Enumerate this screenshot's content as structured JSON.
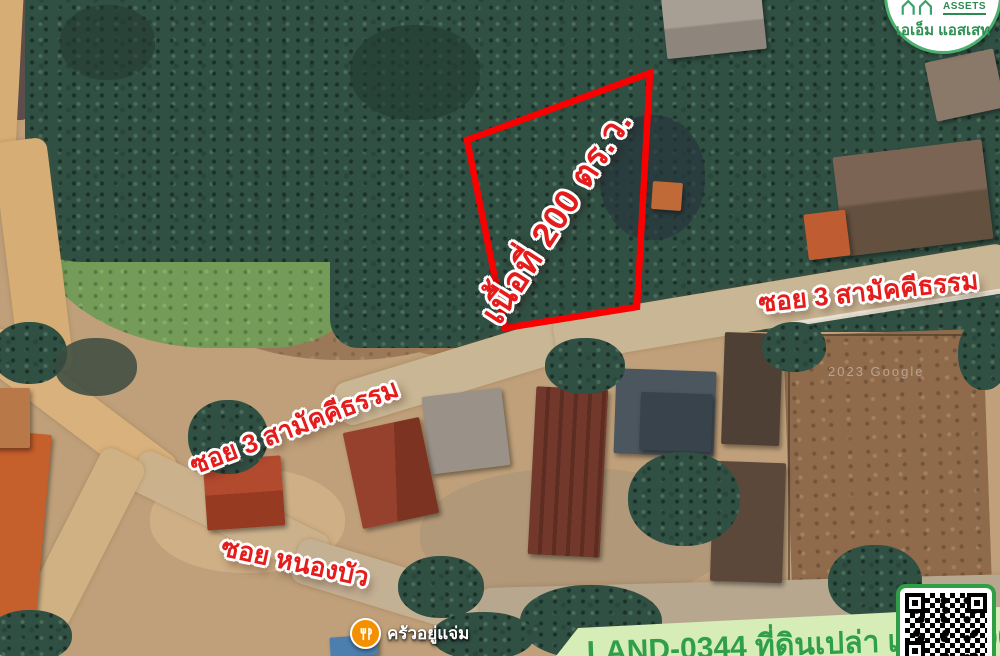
{
  "map": {
    "watermark": "2023 Google",
    "plot_area_label": "เนื้อที่ 200 ตร.ว.",
    "street_labels": {
      "soi3_right": "ซอย 3 สามัคคีธรรม",
      "soi3_left": "ซอย 3 สามัคคีธรรม",
      "soi_nongbua": "ซอย หนองบัว"
    },
    "poi_restaurant": "ครัวอยู่แจ่ม"
  },
  "logo": {
    "brand_en": "ASSETS",
    "brand_th": "เอเอ็ม แอสเสท"
  },
  "footer_banner": {
    "listing_text": "LAND-0344 ที่ดินเปล่า เนื้อที่ 200 ตร.ว."
  },
  "colors": {
    "plot_outline": "#fb0000",
    "label_red": "#e41d1c",
    "banner_bg": "#d6edb7",
    "banner_text": "#2f9e4d",
    "logo_green": "#49b06e",
    "poi_orange": "#f39000"
  }
}
